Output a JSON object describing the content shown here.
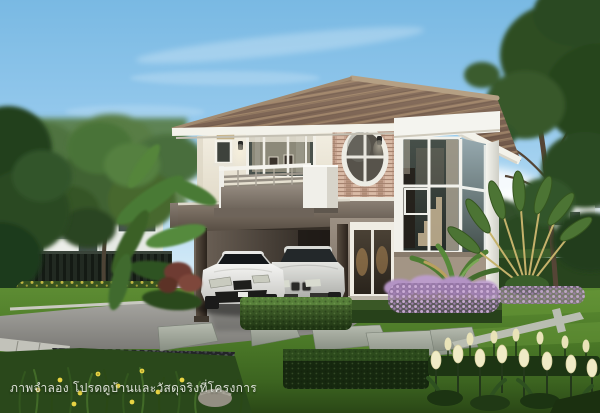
{
  "image": {
    "type": "architectural-exterior-rendering",
    "subject": "Two-story detached house with carport, two cars and landscaped garden",
    "watermark_text": "ภาพจำลอง โปรดดูบ้านและวัสดุจริงที่โครงการ",
    "scene_objects": [
      "sky",
      "clouds",
      "background-trees",
      "background-house",
      "dark-fence",
      "yellow-flower-hedge",
      "main-house",
      "hip-tile-roof",
      "upper-floor-wall",
      "balcony",
      "sliding-glass-door",
      "brick-accent-wall",
      "oval-window",
      "wall-lamps",
      "glass-window-tower",
      "entry-door",
      "carport",
      "white-sports-car",
      "silver-sedan",
      "banana-plants",
      "travelers-palm",
      "purple-flower-beds",
      "trimmed-hedges",
      "driveway",
      "pebble-bed",
      "stepping-stones",
      "lawn",
      "white-tulips",
      "yellow-flowers",
      "watermark-text"
    ],
    "palette": {
      "sky": "#8cc5e9",
      "roof_tile": "#7b6453",
      "upper_wall": "#f2eee3",
      "lower_wall": "#968b80",
      "brick_accent": "#c7a491",
      "carport_fascia": "#6f655c",
      "window_glass": "#3c443f",
      "lawn": "#4e7c29",
      "hedge": "#2c4a1c",
      "purple_flowers": "#b393c4",
      "tulip_cream": "#f0ebc6",
      "car_white": "#ececea",
      "car_silver": "#d6d7d3",
      "driveway": "#9b9a96",
      "fence": "#232a23"
    }
  }
}
